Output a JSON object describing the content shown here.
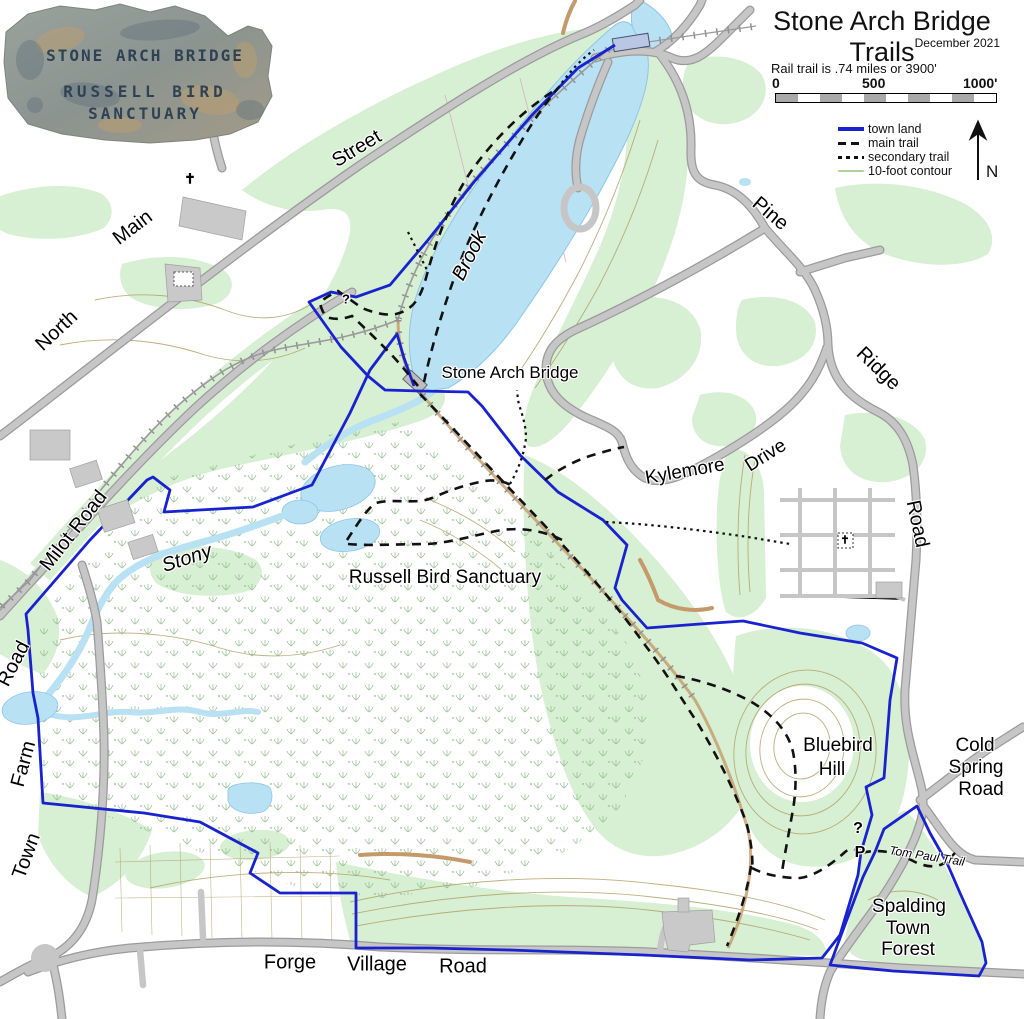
{
  "header": {
    "title": "Stone Arch Bridge Trails",
    "date": "December 2021",
    "rail_note": "Rail trail is .74 miles or 3900'"
  },
  "scalebar": {
    "start": "0",
    "mid": "500",
    "end": "1000'",
    "segments": 10
  },
  "legend": {
    "items": [
      {
        "label": "town land",
        "color": "#1822cf",
        "style": "solid-thick"
      },
      {
        "label": "main trail",
        "color": "#111111",
        "style": "dashed"
      },
      {
        "label": "secondary trail",
        "color": "#111111",
        "style": "dotted"
      },
      {
        "label": "10-foot contour",
        "color": "#b5cf9b",
        "style": "thin-green"
      }
    ]
  },
  "north_arrow": {
    "label": "N"
  },
  "sign": {
    "line1": "STONE ARCH BRIDGE",
    "line2": "RUSSELL BIRD",
    "line3": "SANCTUARY"
  },
  "colors": {
    "town_land": "#1822cf",
    "trail": "#111111",
    "contour": "#b2a268",
    "water": "#b9e1f4",
    "forest": "#d7efd2",
    "road": "#c6c6c6"
  },
  "map_labels": [
    {
      "name": "label-north",
      "text": "North",
      "x": 57,
      "y": 331,
      "rot": -43,
      "size": 20,
      "cls": ""
    },
    {
      "name": "label-main",
      "text": "Main",
      "x": 133,
      "y": 228,
      "rot": -37,
      "size": 20,
      "cls": ""
    },
    {
      "name": "label-street",
      "text": "Street",
      "x": 357,
      "y": 149,
      "rot": -31,
      "size": 20,
      "cls": ""
    },
    {
      "name": "label-milot-road",
      "text": "Milot Road",
      "x": 74,
      "y": 531,
      "rot": -52,
      "size": 20,
      "cls": ""
    },
    {
      "name": "label-stony",
      "text": "Stony",
      "x": 187,
      "y": 559,
      "rot": -18,
      "size": 20,
      "cls": "it"
    },
    {
      "name": "label-brook",
      "text": "Brook",
      "x": 470,
      "y": 256,
      "rot": -63,
      "size": 20,
      "cls": "it"
    },
    {
      "name": "label-stone-arch-bridge",
      "text": "Stone Arch Bridge",
      "x": 510,
      "y": 373,
      "rot": 0,
      "size": 17,
      "cls": ""
    },
    {
      "name": "label-russell-bird-sanctuary",
      "text": "Russell Bird Sanctuary",
      "x": 445,
      "y": 578,
      "rot": 0,
      "size": 19,
      "cls": ""
    },
    {
      "name": "label-kylemore",
      "text": "Kylemore",
      "x": 685,
      "y": 472,
      "rot": -10,
      "size": 19,
      "cls": ""
    },
    {
      "name": "label-drive",
      "text": "Drive",
      "x": 766,
      "y": 456,
      "rot": -32,
      "size": 19,
      "cls": ""
    },
    {
      "name": "label-pine",
      "text": "Pine",
      "x": 770,
      "y": 214,
      "rot": 40,
      "size": 20,
      "cls": ""
    },
    {
      "name": "label-ridge",
      "text": "Ridge",
      "x": 878,
      "y": 369,
      "rot": 44,
      "size": 20,
      "cls": ""
    },
    {
      "name": "label-pine-ridge-road",
      "text": "Road",
      "x": 917,
      "y": 524,
      "rot": 78,
      "size": 20,
      "cls": ""
    },
    {
      "name": "label-cold",
      "text": "Cold",
      "x": 975,
      "y": 746,
      "rot": 0,
      "size": 19,
      "cls": ""
    },
    {
      "name": "label-spring",
      "text": "Spring",
      "x": 976,
      "y": 768,
      "rot": 0,
      "size": 19,
      "cls": ""
    },
    {
      "name": "label-cold-spring-road",
      "text": "Road",
      "x": 981,
      "y": 790,
      "rot": 0,
      "size": 19,
      "cls": ""
    },
    {
      "name": "label-bluebird",
      "text": "Bluebird",
      "x": 838,
      "y": 746,
      "rot": 0,
      "size": 19,
      "cls": ""
    },
    {
      "name": "label-hill",
      "text": "Hill",
      "x": 832,
      "y": 770,
      "rot": 0,
      "size": 19,
      "cls": ""
    },
    {
      "name": "label-spalding",
      "text": "Spalding",
      "x": 909,
      "y": 907,
      "rot": 0,
      "size": 19,
      "cls": ""
    },
    {
      "name": "label-spalding-town",
      "text": "Town",
      "x": 908,
      "y": 929,
      "rot": 0,
      "size": 19,
      "cls": ""
    },
    {
      "name": "label-spalding-forest",
      "text": "Forest",
      "x": 908,
      "y": 950,
      "rot": 0,
      "size": 19,
      "cls": ""
    },
    {
      "name": "label-tom-paul-trail",
      "text": "Tom  Paul  Trail",
      "x": 927,
      "y": 856,
      "rot": 9,
      "size": 12,
      "cls": "it"
    },
    {
      "name": "label-forge",
      "text": "Forge",
      "x": 290,
      "y": 963,
      "rot": 0,
      "size": 20,
      "cls": ""
    },
    {
      "name": "label-village",
      "text": "Village",
      "x": 377,
      "y": 965,
      "rot": 0,
      "size": 20,
      "cls": ""
    },
    {
      "name": "label-forge-village-road",
      "text": "Road",
      "x": 463,
      "y": 967,
      "rot": 0,
      "size": 20,
      "cls": ""
    },
    {
      "name": "label-town",
      "text": "Town",
      "x": 27,
      "y": 856,
      "rot": -70,
      "size": 20,
      "cls": ""
    },
    {
      "name": "label-farm",
      "text": "Farm",
      "x": 24,
      "y": 764,
      "rot": -75,
      "size": 20,
      "cls": ""
    },
    {
      "name": "label-town-farm-road",
      "text": "Road",
      "x": 14,
      "y": 664,
      "rot": -63,
      "size": 20,
      "cls": ""
    },
    {
      "name": "kiosk-icon",
      "text": "?",
      "x": 858,
      "y": 829,
      "rot": 0,
      "size": 16,
      "cls": "sym"
    },
    {
      "name": "parking-icon",
      "text": "P",
      "x": 860,
      "y": 853,
      "rot": 0,
      "size": 16,
      "cls": "sym"
    },
    {
      "name": "kiosk-icon",
      "text": "?",
      "x": 346,
      "y": 299,
      "rot": 0,
      "size": 13,
      "cls": "sym"
    },
    {
      "name": "church-icon",
      "text": "✝",
      "x": 190,
      "y": 179,
      "rot": 0,
      "size": 14,
      "cls": "sym"
    },
    {
      "name": "cemetery-icon",
      "text": "✝",
      "x": 845,
      "y": 540,
      "rot": 0,
      "size": 11,
      "cls": "sym"
    }
  ]
}
